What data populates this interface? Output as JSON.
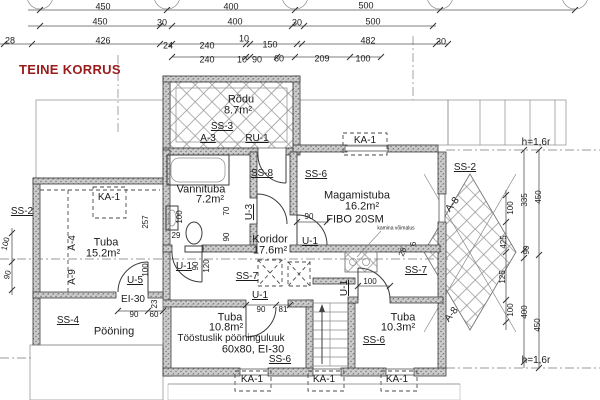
{
  "page_title": "TEINE KORRUS",
  "accent_color": "#9b1b1b",
  "rooms": [
    {
      "name": "Rõdu",
      "area": "8.7m²"
    },
    {
      "name": "Vannituba",
      "area": "7.2m²"
    },
    {
      "name": "Koridor",
      "area": "17.6m²"
    },
    {
      "name": "Magamistuba",
      "area": "16.2m²"
    },
    {
      "name": "Tuba",
      "area": "15.2m²"
    },
    {
      "name": "Tuba",
      "area": "10.8m²"
    },
    {
      "name": "Tuba",
      "area": "10.3m²"
    },
    {
      "name": "Pööning",
      "area": ""
    }
  ],
  "notes": [
    "FIBO 20SM",
    "kamina võimalus",
    "Tööstuslik pööninguluuk 60x80, EI-30",
    "h=1,6r"
  ],
  "labels": [
    {
      "t": "450",
      "x": 103,
      "y": 7,
      "s": 9
    },
    {
      "t": "400",
      "x": 231,
      "y": 7,
      "s": 9
    },
    {
      "t": "500",
      "x": 366,
      "y": 6,
      "s": 9
    },
    {
      "t": "450",
      "x": 100,
      "y": 22,
      "s": 9
    },
    {
      "t": "30",
      "x": 162,
      "y": 23,
      "s": 9
    },
    {
      "t": "400",
      "x": 235,
      "y": 22,
      "s": 9
    },
    {
      "t": "30",
      "x": 297,
      "y": 23,
      "s": 9
    },
    {
      "t": "500",
      "x": 373,
      "y": 22,
      "s": 9
    },
    {
      "t": "28",
      "x": 10,
      "y": 41,
      "s": 9
    },
    {
      "t": "426",
      "x": 103,
      "y": 41,
      "s": 9
    },
    {
      "t": "24",
      "x": 168,
      "y": 46,
      "s": 9
    },
    {
      "t": "240",
      "x": 207,
      "y": 46,
      "s": 9
    },
    {
      "t": "10",
      "x": 244,
      "y": 39,
      "s": 9
    },
    {
      "t": "150",
      "x": 270,
      "y": 45,
      "s": 9
    },
    {
      "t": "482",
      "x": 368,
      "y": 41,
      "s": 9
    },
    {
      "t": "30",
      "x": 441,
      "y": 42,
      "s": 9
    },
    {
      "t": "240",
      "x": 207,
      "y": 60,
      "s": 9
    },
    {
      "t": "10",
      "x": 242,
      "y": 60,
      "s": 9
    },
    {
      "t": "90",
      "x": 257,
      "y": 60,
      "s": 9
    },
    {
      "t": "60",
      "x": 279,
      "y": 59,
      "s": 9
    },
    {
      "t": "209",
      "x": 322,
      "y": 59,
      "s": 9
    },
    {
      "t": "100",
      "x": 363,
      "y": 59,
      "s": 9
    },
    {
      "t": "Rõdu",
      "x": 241,
      "y": 100,
      "s": 11,
      "n": "room-rodu"
    },
    {
      "t": "8.7m²",
      "x": 238,
      "y": 111,
      "s": 11
    },
    {
      "t": "SS-3",
      "x": 222,
      "y": 127,
      "u": true
    },
    {
      "t": "A-3",
      "x": 208,
      "y": 139,
      "u": true
    },
    {
      "t": "RU-1",
      "x": 257,
      "y": 139,
      "u": true
    },
    {
      "t": "SS-8",
      "x": 262,
      "y": 174,
      "u": true
    },
    {
      "t": "SS-6",
      "x": 316,
      "y": 175,
      "u": true
    },
    {
      "t": "KA-1",
      "x": 365,
      "y": 141
    },
    {
      "t": "SS-2",
      "x": 465,
      "y": 168,
      "u": true
    },
    {
      "t": "Vannituba",
      "x": 201,
      "y": 190,
      "s": 11,
      "n": "room-vannituba"
    },
    {
      "t": "7.2m²",
      "x": 210,
      "y": 200,
      "s": 11
    },
    {
      "t": "100",
      "x": 180,
      "y": 217,
      "r": -90,
      "s": 8
    },
    {
      "t": "29",
      "x": 176,
      "y": 236,
      "s": 8
    },
    {
      "t": "70",
      "x": 227,
      "y": 211,
      "r": -90,
      "s": 8
    },
    {
      "t": "U-3",
      "x": 250,
      "y": 212,
      "r": -90,
      "u": true
    },
    {
      "t": "90",
      "x": 227,
      "y": 237,
      "r": -90,
      "s": 8
    },
    {
      "t": "U-1",
      "x": 184,
      "y": 267,
      "u": true
    },
    {
      "t": "90",
      "x": 196,
      "y": 266,
      "r": -90,
      "s": 8
    },
    {
      "t": "120",
      "x": 207,
      "y": 266,
      "r": -90,
      "s": 8
    },
    {
      "t": "KA-1",
      "x": 109,
      "y": 198
    },
    {
      "t": "257",
      "x": 146,
      "y": 222,
      "r": -90,
      "s": 8
    },
    {
      "t": "Tuba",
      "x": 106,
      "y": 243,
      "s": 11,
      "n": "room-tuba-152"
    },
    {
      "t": "15.2m²",
      "x": 103,
      "y": 254,
      "s": 11
    },
    {
      "t": "SS-2",
      "x": 22,
      "y": 212,
      "u": true
    },
    {
      "t": "A-4",
      "x": 73,
      "y": 243,
      "r": -90
    },
    {
      "t": "A-9",
      "x": 73,
      "y": 277,
      "r": -90
    },
    {
      "t": "100",
      "x": 6,
      "y": 244,
      "r": -75,
      "s": 8
    },
    {
      "t": "90",
      "x": 8,
      "y": 275,
      "r": -75,
      "s": 8
    },
    {
      "t": "U-5",
      "x": 135,
      "y": 281,
      "u": true
    },
    {
      "t": "100",
      "x": 146,
      "y": 270,
      "r": -90,
      "s": 8
    },
    {
      "t": "EI-30",
      "x": 133,
      "y": 300
    },
    {
      "t": "23",
      "x": 155,
      "y": 304,
      "r": -90,
      "s": 8
    },
    {
      "t": "90",
      "x": 134,
      "y": 315,
      "s": 8
    },
    {
      "t": "60",
      "x": 154,
      "y": 315,
      "s": 8
    },
    {
      "t": "SS-4",
      "x": 68,
      "y": 321,
      "u": true
    },
    {
      "t": "Pööning",
      "x": 114,
      "y": 332,
      "s": 11,
      "n": "room-pooning"
    },
    {
      "t": "Koridor",
      "x": 270,
      "y": 240,
      "s": 11,
      "n": "room-koridor"
    },
    {
      "t": "17.6m²",
      "x": 270,
      "y": 251,
      "s": 11
    },
    {
      "t": "Magamistuba",
      "x": 357,
      "y": 196,
      "s": 11,
      "n": "room-magamistuba"
    },
    {
      "t": "16.2m²",
      "x": 362,
      "y": 207,
      "s": 11
    },
    {
      "t": "FIBO 20SM",
      "x": 355,
      "y": 220,
      "s": 11
    },
    {
      "t": "90",
      "x": 309,
      "y": 217,
      "s": 8
    },
    {
      "t": "U-1",
      "x": 310,
      "y": 242,
      "u": true
    },
    {
      "t": "kamina võimalus",
      "x": 396,
      "y": 229,
      "s": 5
    },
    {
      "t": "28",
      "x": 403,
      "y": 252,
      "r": -70,
      "s": 8
    },
    {
      "t": "6",
      "x": 414,
      "y": 244,
      "r": -90,
      "s": 8
    },
    {
      "t": "SS-7",
      "x": 247,
      "y": 277,
      "u": true
    },
    {
      "t": "SS-7",
      "x": 416,
      "y": 271,
      "u": true
    },
    {
      "t": "U-1",
      "x": 260,
      "y": 296,
      "u": true
    },
    {
      "t": "90",
      "x": 261,
      "y": 310,
      "s": 8
    },
    {
      "t": "81",
      "x": 283,
      "y": 310,
      "s": 8
    },
    {
      "t": "Tuba",
      "x": 230,
      "y": 318,
      "s": 11,
      "n": "room-tuba-108"
    },
    {
      "t": "10.8m²",
      "x": 226,
      "y": 328,
      "s": 11
    },
    {
      "t": "Tööstuslik pööninguluuk",
      "x": 231,
      "y": 339,
      "s": 10
    },
    {
      "t": "60x80,  EI-30",
      "x": 253,
      "y": 350,
      "s": 11
    },
    {
      "t": "SS-6",
      "x": 280,
      "y": 360,
      "u": true
    },
    {
      "t": "U-1",
      "x": 345,
      "y": 288,
      "r": -90,
      "u": true
    },
    {
      "t": "100",
      "x": 370,
      "y": 282,
      "s": 8
    },
    {
      "t": "Tuba",
      "x": 403,
      "y": 318,
      "s": 11,
      "n": "room-tuba-103"
    },
    {
      "t": "10.3m²",
      "x": 398,
      "y": 328,
      "s": 11
    },
    {
      "t": "SS-6",
      "x": 374,
      "y": 341,
      "u": true
    },
    {
      "t": "A-8",
      "x": 453,
      "y": 205,
      "r": -52
    },
    {
      "t": "A-8",
      "x": 452,
      "y": 315,
      "r": -52
    },
    {
      "t": "h=1,6r",
      "x": 536,
      "y": 143
    },
    {
      "t": "450",
      "x": 539,
      "y": 197,
      "r": -90,
      "s": 8
    },
    {
      "t": "335",
      "x": 525,
      "y": 200,
      "r": -90,
      "s": 8
    },
    {
      "t": "100",
      "x": 511,
      "y": 208,
      "r": -90,
      "s": 8
    },
    {
      "t": "425",
      "x": 504,
      "y": 242,
      "r": -90,
      "s": 8
    },
    {
      "t": "90",
      "x": 527,
      "y": 250,
      "r": -90,
      "s": 8
    },
    {
      "t": "125",
      "x": 503,
      "y": 277,
      "r": -90,
      "s": 8
    },
    {
      "t": "100",
      "x": 511,
      "y": 310,
      "r": -90,
      "s": 8
    },
    {
      "t": "400",
      "x": 525,
      "y": 312,
      "r": -90,
      "s": 8
    },
    {
      "t": "450",
      "x": 538,
      "y": 325,
      "r": -90,
      "s": 8
    },
    {
      "t": "h=1,6r",
      "x": 536,
      "y": 361
    },
    {
      "t": "KA-1",
      "x": 252,
      "y": 380
    },
    {
      "t": "KA-1",
      "x": 324,
      "y": 380
    },
    {
      "t": "KA-1",
      "x": 397,
      "y": 380
    }
  ]
}
